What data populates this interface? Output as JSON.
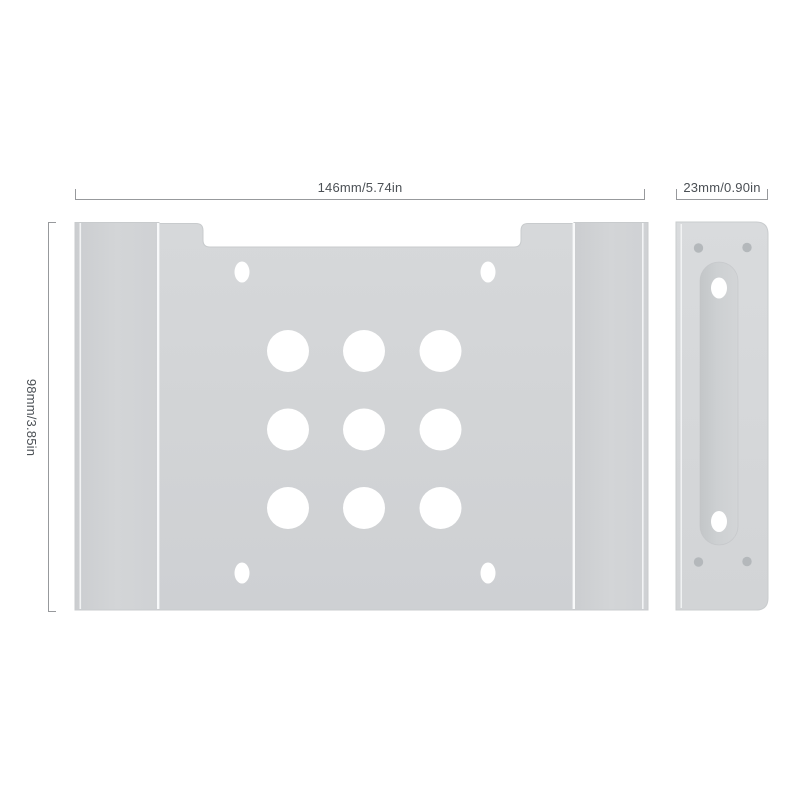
{
  "diagram": {
    "dimensions": {
      "main_width": {
        "label": "146mm/5.74in"
      },
      "side_width": {
        "label": "23mm/0.90in"
      },
      "height": {
        "label": "98mm/3.85in"
      }
    },
    "colors": {
      "background": "#ffffff",
      "dimension_line": "#97999c",
      "dimension_text": "#4b5055",
      "metal_face": "#d3d5d7",
      "metal_face_light": "#d9dbdd",
      "metal_edge": "#c8cbcd",
      "slot_recess": "#c9ccce",
      "hole": "#ffffff",
      "screw_hole": "#b4b8bb",
      "highlight_line": "#f8f9fa"
    }
  }
}
